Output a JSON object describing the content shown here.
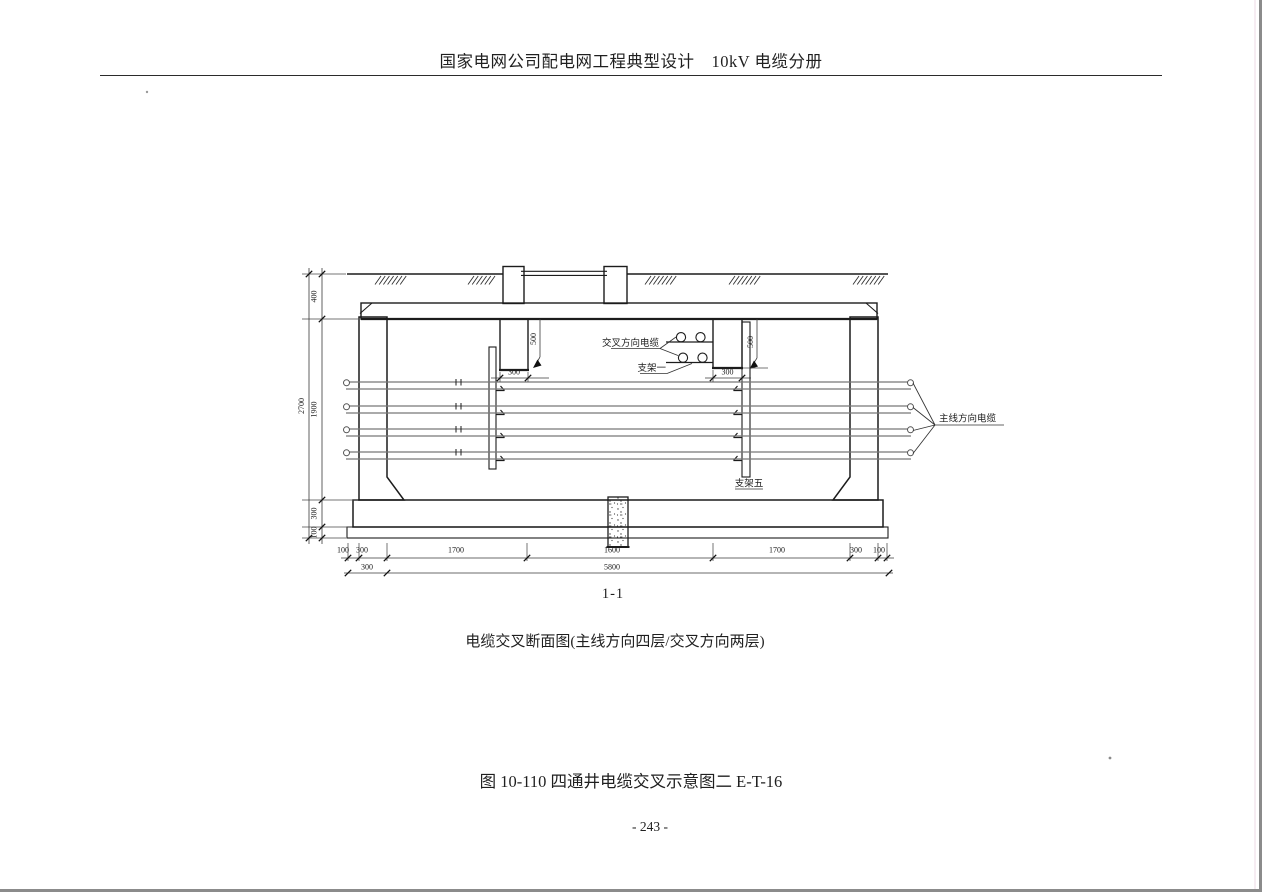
{
  "page": {
    "header_title": "国家电网公司配电网工程典型设计　10kV 电缆分册",
    "section_label": "1-1",
    "drawing_caption": "电缆交叉断面图(主线方向四层/交叉方向两层)",
    "figure_caption": "图 10-110 四通井电缆交叉示意图二  E-T-16",
    "page_number": "- 243 -"
  },
  "drawing": {
    "labels": {
      "crossing_cable": "交叉方向电缆",
      "bracket_one": "支架一",
      "main_cable": "主线方向电缆",
      "bracket_five": "支架五"
    },
    "dimensions": {
      "overall_height": "2700",
      "cover_depth": "400",
      "inner_height": "1900",
      "base_slab": "300",
      "cushion": "100",
      "hang_left_depth": "500",
      "hang_left_width": "300",
      "hang_right_depth": "500",
      "hang_right_width": "300",
      "bottom_row": [
        "100",
        "300",
        "1700",
        "1600",
        "1700",
        "300",
        "100"
      ],
      "wall_offset": "300",
      "overall_width": "5800"
    }
  }
}
